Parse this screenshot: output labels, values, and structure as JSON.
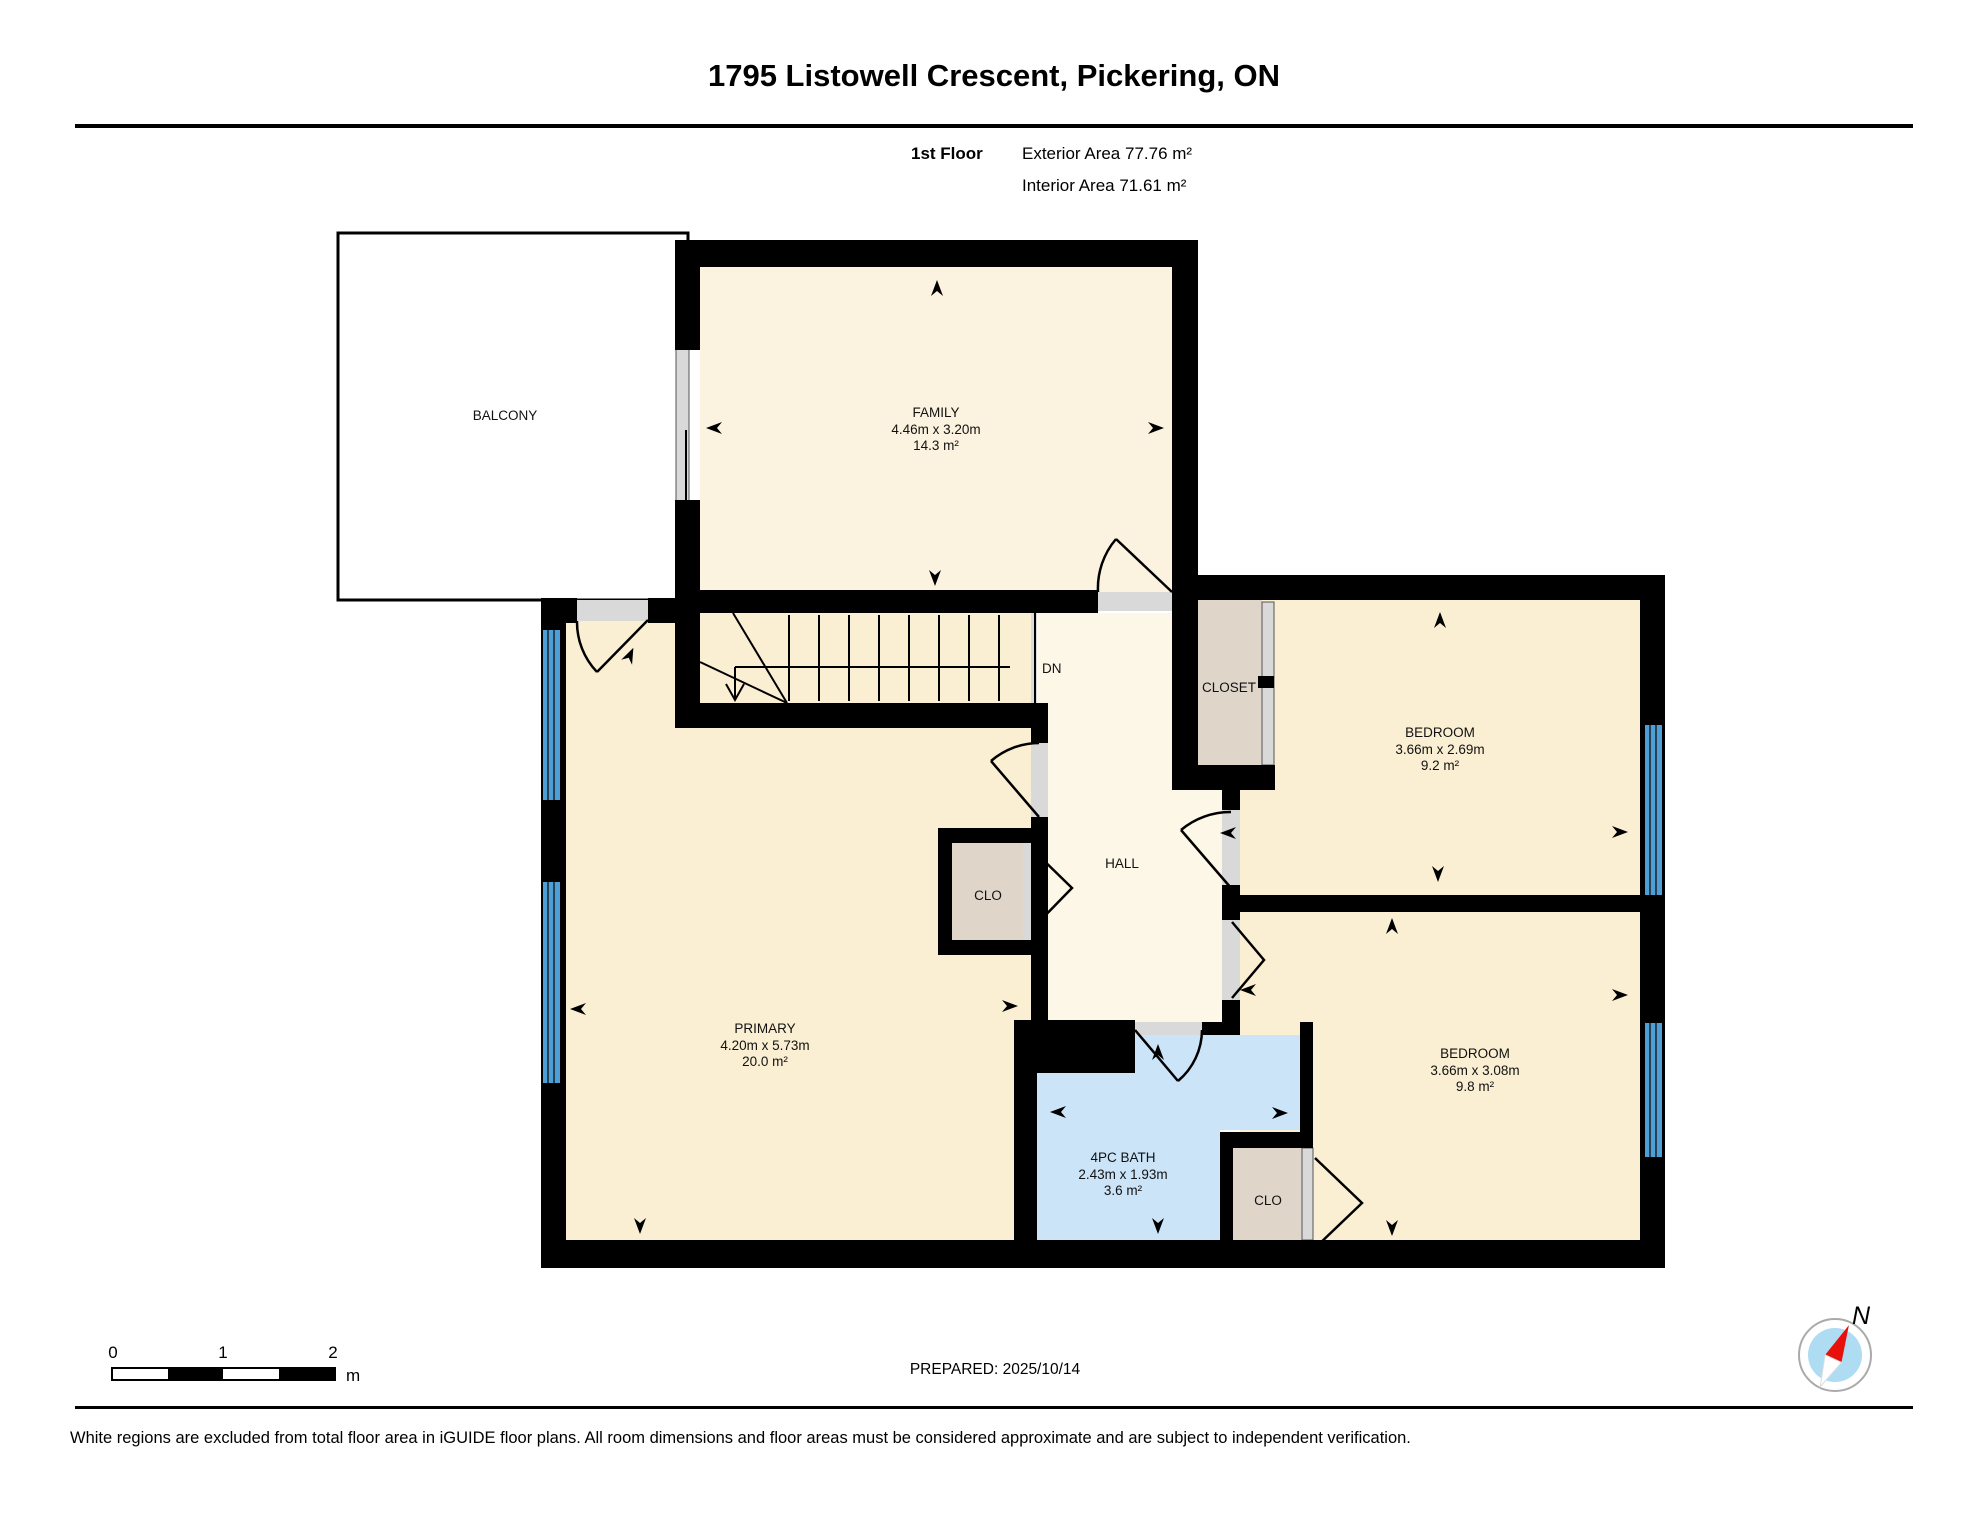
{
  "header": {
    "title": "1795 Listowell Crescent, Pickering, ON",
    "floor_label": "1st Floor",
    "exterior_area": "Exterior Area 77.76 m²",
    "interior_area": "Interior Area 71.61 m²"
  },
  "rooms": {
    "balcony": {
      "name": "BALCONY"
    },
    "family": {
      "name": "FAMILY",
      "dims": "4.46m x 3.20m",
      "area": "14.3 m²"
    },
    "bedroom1": {
      "name": "BEDROOM",
      "dims": "3.66m x 2.69m",
      "area": "9.2 m²"
    },
    "bedroom2": {
      "name": "BEDROOM",
      "dims": "3.66m x 3.08m",
      "area": "9.8 m²"
    },
    "primary": {
      "name": "PRIMARY",
      "dims": "4.20m x 5.73m",
      "area": "20.0 m²"
    },
    "bath": {
      "name": "4PC BATH",
      "dims": "2.43m x 1.93m",
      "area": "3.6 m²"
    },
    "hall": {
      "name": "HALL"
    },
    "closet": {
      "name": "CLOSET"
    },
    "clo_hall": {
      "name": "CLO"
    },
    "clo_bedroom": {
      "name": "CLO"
    },
    "stairs": {
      "down_label": "DN"
    }
  },
  "scale_bar": {
    "ticks": [
      "0",
      "1",
      "2"
    ],
    "unit": "m"
  },
  "footer": {
    "prepared": "PREPARED: 2025/10/14",
    "disclaimer": "White regions are excluded from total floor area in iGUIDE floor plans. All room dimensions and floor areas must be considered approximate and are subject to independent verification."
  },
  "compass": {
    "north_label": "N"
  },
  "colors": {
    "wall_black": "#000000",
    "room_fill": "#FAEFD2",
    "family_fill": "#FBF3DF",
    "hall_fill": "#FCF7E7",
    "bath_fill": "#CBE4F8",
    "closet_fill": "#DFD6C9",
    "stairs_fill": "#DBDBDB",
    "window_blue": "#4C9FD7",
    "door_gray": "#D9D9D9",
    "compass_blue": "#AEDCF2",
    "compass_red": "#E8100C"
  }
}
